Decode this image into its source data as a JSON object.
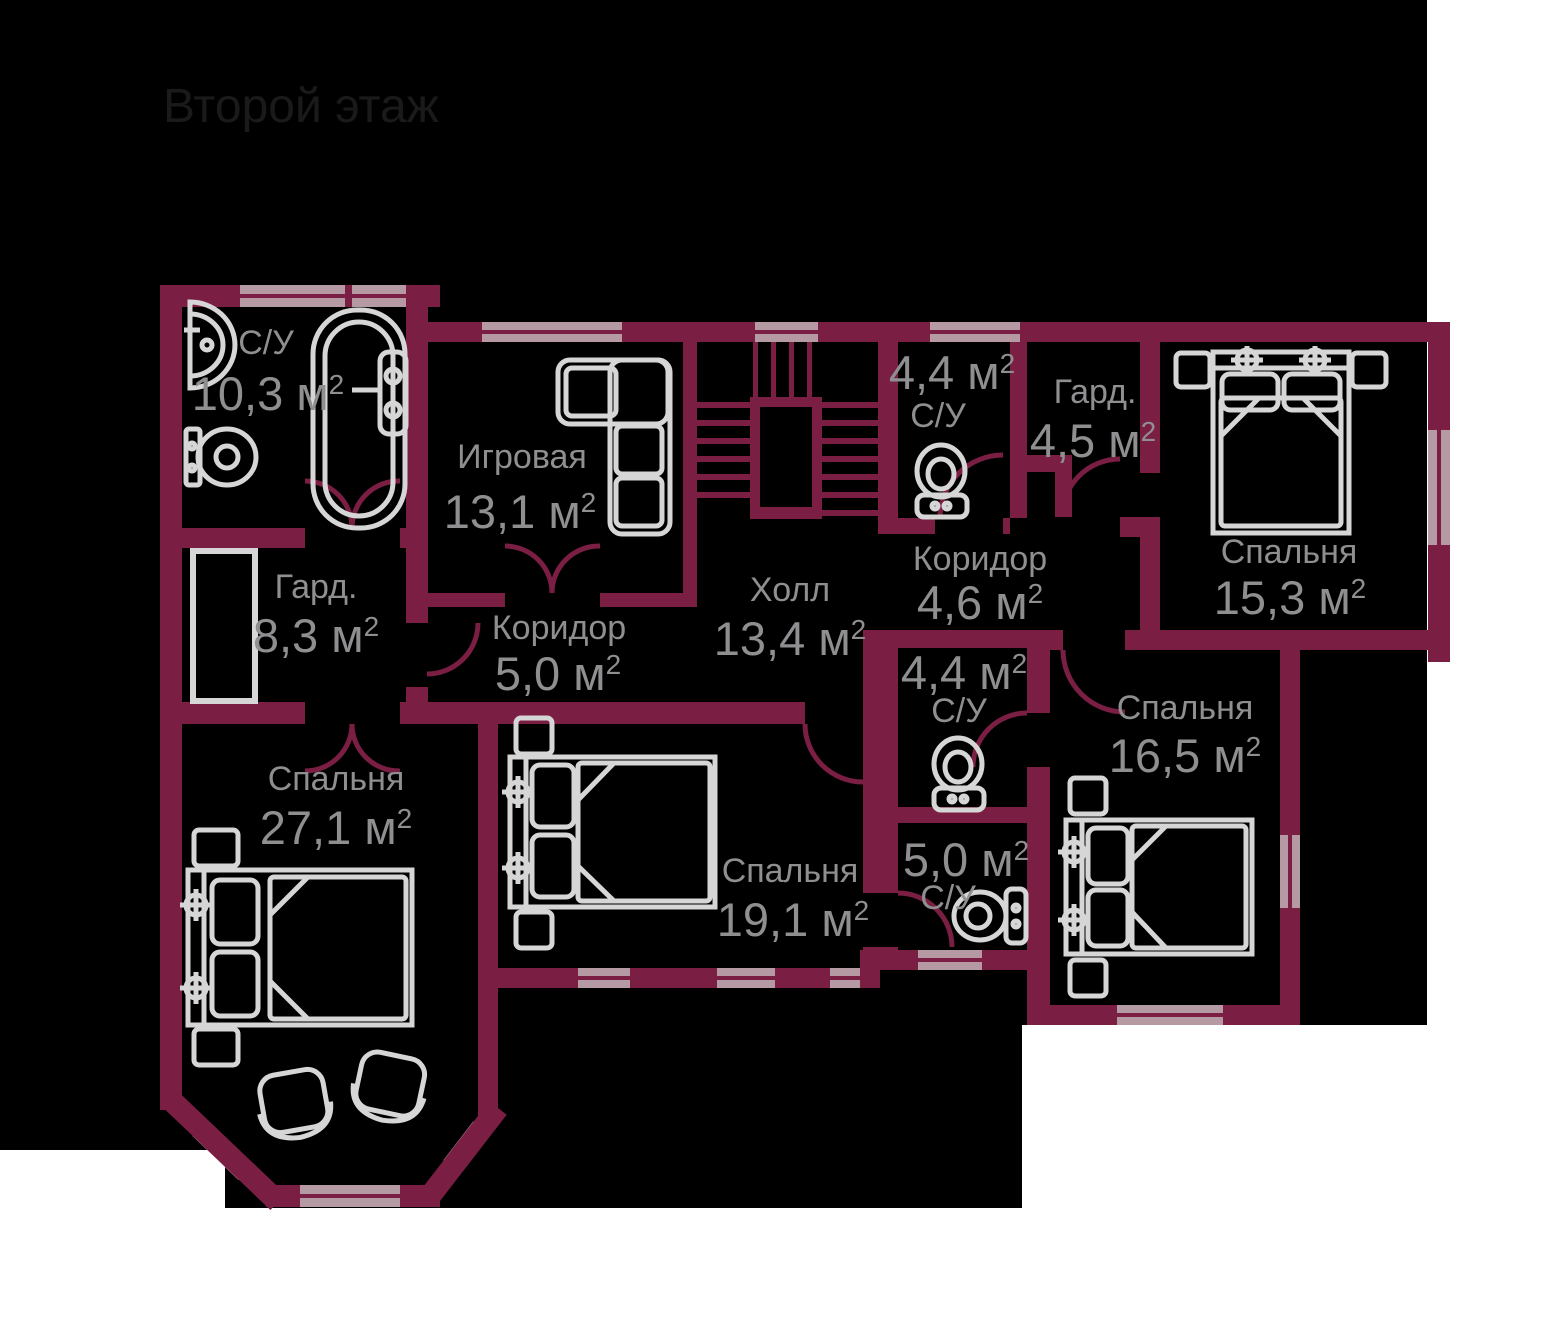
{
  "title": "Второй этаж",
  "sup": "2",
  "colors": {
    "background": "#000000",
    "margin": "#ffffff",
    "wall": "#7b1e44",
    "window": "#b59aa4",
    "furniture": "#d6d6d6",
    "label": "#8f8f91",
    "title_color": "#1a1a1a"
  },
  "rooms": [
    {
      "name": "С/У",
      "area": "10,3 м"
    },
    {
      "name": "Игровая",
      "area": "13,1 м"
    },
    {
      "name": "Гард.",
      "area": "8,3 м"
    },
    {
      "name": "Коридор",
      "area": "5,0 м"
    },
    {
      "name": "Холл",
      "area": "13,4 м"
    },
    {
      "name": "С/У",
      "area": "4,4 м"
    },
    {
      "name": "Гард.",
      "area": "4,5 м"
    },
    {
      "name": "Коридор",
      "area": "4,6 м"
    },
    {
      "name": "Спальня",
      "area": "15,3 м"
    },
    {
      "name": "Спальня",
      "area": "27,1 м"
    },
    {
      "name": "Спальня",
      "area": "19,1 м"
    },
    {
      "name": "С/У",
      "area": "4,4 м"
    },
    {
      "name": "Спальня",
      "area": "16,5 м"
    },
    {
      "name": "С/У",
      "area": "5,0 м"
    }
  ]
}
